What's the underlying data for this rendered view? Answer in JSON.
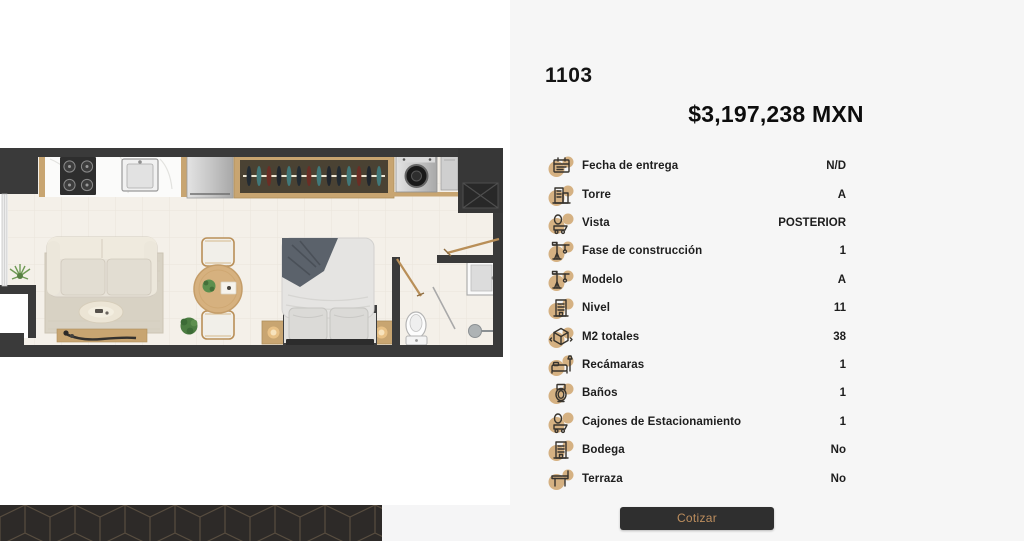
{
  "panel": {
    "unit_number": "1103",
    "price": "$3,197,238 MXN",
    "details": [
      {
        "icon": "calendar-icon",
        "label": "Fecha de entrega",
        "value": "N/D"
      },
      {
        "icon": "tower-icon",
        "label": "Torre",
        "value": "A"
      },
      {
        "icon": "view-icon",
        "label": "Vista",
        "value": "POSTERIOR"
      },
      {
        "icon": "crane-icon",
        "label": "Fase de construcción",
        "value": "1"
      },
      {
        "icon": "crane-icon",
        "label": "Modelo",
        "value": "A"
      },
      {
        "icon": "building-icon",
        "label": "Nivel",
        "value": "11"
      },
      {
        "icon": "area-cube-icon",
        "label": "M2 totales",
        "value": "38"
      },
      {
        "icon": "bed-icon",
        "label": "Recámaras",
        "value": "1"
      },
      {
        "icon": "toilet-icon",
        "label": "Baños",
        "value": "1"
      },
      {
        "icon": "parking-icon",
        "label": "Cajones de Estacionamiento",
        "value": "1"
      },
      {
        "icon": "building-icon",
        "label": "Bodega",
        "value": "No"
      },
      {
        "icon": "terrace-icon",
        "label": "Terraza",
        "value": "No"
      }
    ],
    "cta_label": "Cotizar"
  },
  "colors": {
    "panel_bg": "#f6f6f6",
    "accent_tan": "#cfa56d",
    "button_bg": "#2f2f2f",
    "button_text": "#bd8e5e",
    "wall": "#3a3a3a",
    "wood": "#c8a571",
    "floor": "#f4f0e9",
    "pattern_bg": "#2d2a28"
  }
}
